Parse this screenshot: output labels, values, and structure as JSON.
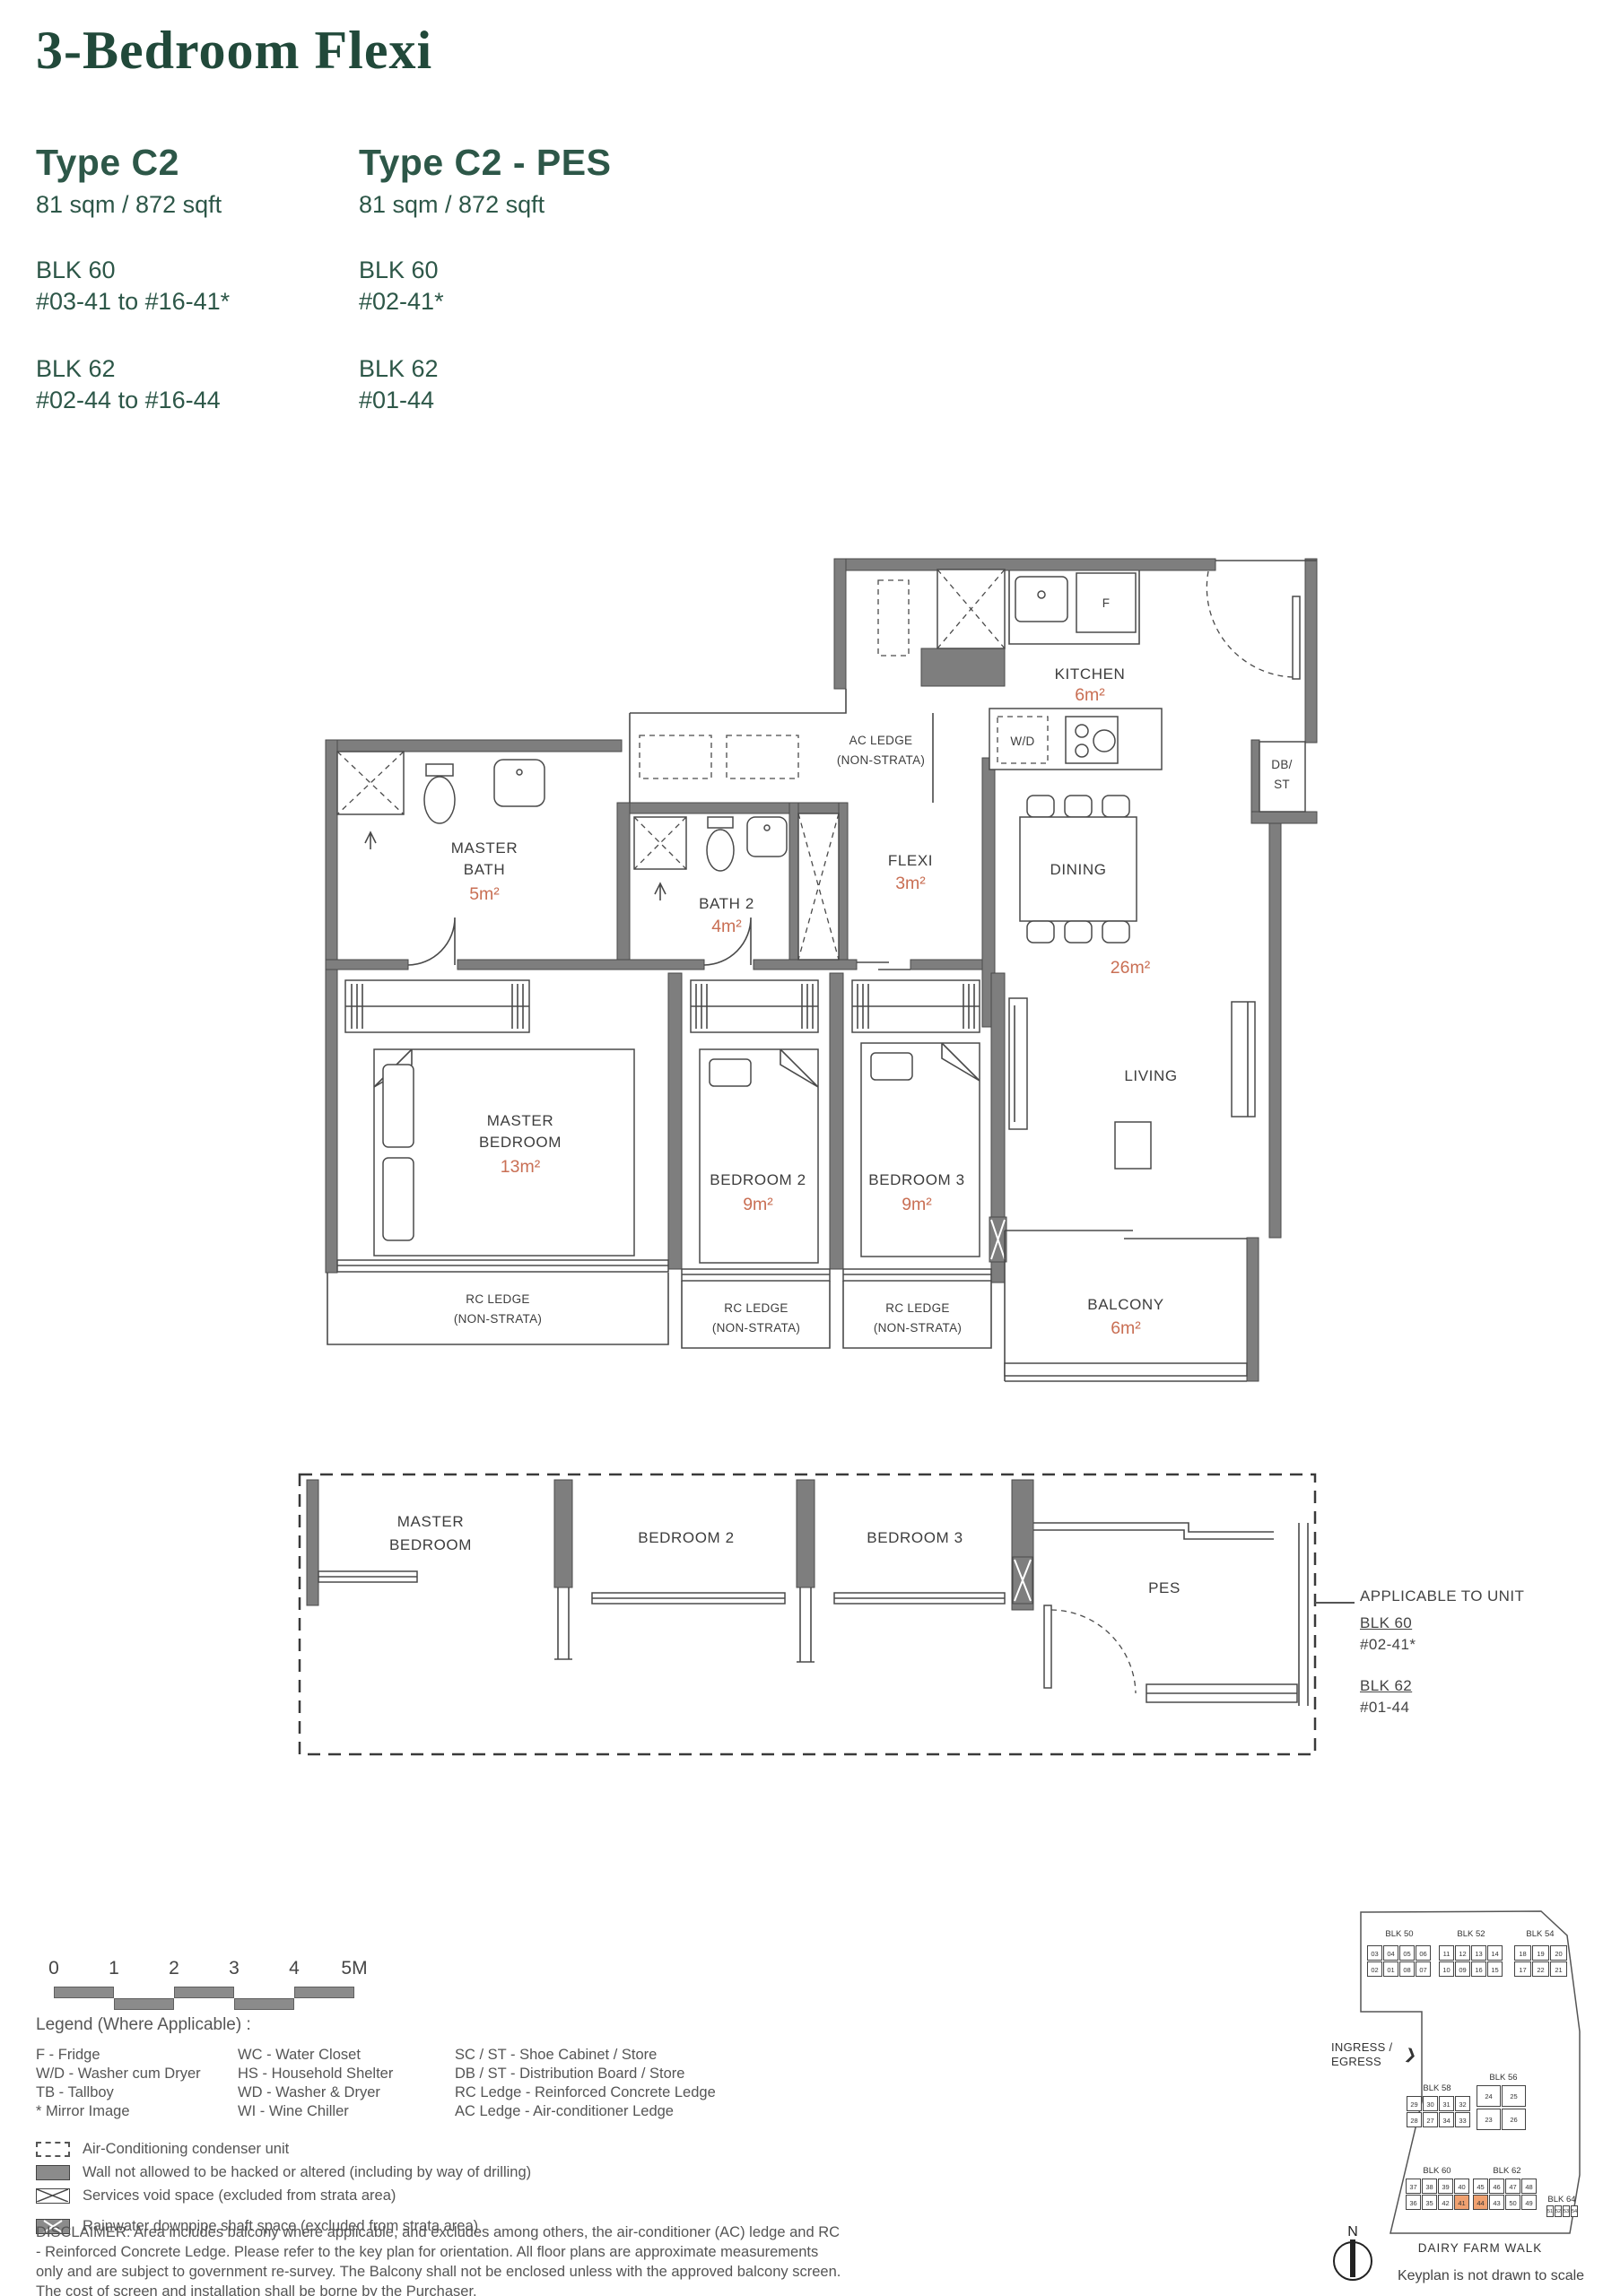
{
  "header": {
    "title": "3-Bedroom Flexi",
    "types": [
      {
        "name": "Type C2",
        "area": "81 sqm / 872 sqft",
        "blocks": [
          {
            "blk": "BLK 60",
            "units": "#03-41 to #16-41*"
          },
          {
            "blk": "BLK 62",
            "units": "#02-44 to #16-44"
          }
        ]
      },
      {
        "name": "Type C2 - PES",
        "area": "81 sqm / 872 sqft",
        "blocks": [
          {
            "blk": "BLK 60",
            "units": "#02-41*"
          },
          {
            "blk": "BLK 62",
            "units": "#01-44"
          }
        ]
      }
    ]
  },
  "floorplan": {
    "kitchen": {
      "label": "KITCHEN",
      "area": "6m²"
    },
    "fridge": "F",
    "washer_dryer": "W/D",
    "db_st": {
      "l1": "DB/",
      "l2": "ST"
    },
    "ac_ledge": {
      "l1": "AC LEDGE",
      "l2": "(NON-STRATA)"
    },
    "master_bath": {
      "l1": "MASTER",
      "l2": "BATH",
      "area": "5m²"
    },
    "bath2": {
      "label": "BATH 2",
      "area": "4m²"
    },
    "flexi": {
      "label": "FLEXI",
      "area": "3m²"
    },
    "dining": {
      "label": "DINING"
    },
    "living": {
      "label": "LIVING"
    },
    "living_dining_area": "26m²",
    "master_bedroom": {
      "l1": "MASTER",
      "l2": "BEDROOM",
      "area": "13m²"
    },
    "bedroom2": {
      "label": "BEDROOM 2",
      "area": "9m²"
    },
    "bedroom3": {
      "label": "BEDROOM 3",
      "area": "9m²"
    },
    "balcony": {
      "label": "BALCONY",
      "area": "6m²"
    },
    "rc_ledge": {
      "l1": "RC LEDGE",
      "l2": "(NON-STRATA)"
    }
  },
  "pes_plan": {
    "master_bedroom": {
      "l1": "MASTER",
      "l2": "BEDROOM"
    },
    "bedroom2": "BEDROOM 2",
    "bedroom3": "BEDROOM 3",
    "pes": "PES",
    "note": {
      "title": "APPLICABLE TO UNIT",
      "blk1": "BLK 60",
      "unit1": "#02-41*",
      "blk2": "BLK 62",
      "unit2": "#01-44"
    }
  },
  "scalebar": {
    "ticks": [
      "0",
      "1",
      "2",
      "3",
      "4",
      "5M"
    ]
  },
  "legend": {
    "heading": "Legend (Where Applicable) :",
    "col1": [
      "F - Fridge",
      "W/D - Washer cum Dryer",
      "TB - Tallboy",
      "* Mirror Image"
    ],
    "col2": [
      "WC - Water Closet",
      "HS - Household Shelter",
      "WD - Washer & Dryer",
      "WI  - Wine Chiller"
    ],
    "col3": [
      "SC / ST - Shoe Cabinet / Store",
      "DB / ST - Distribution Board / Store",
      "RC Ledge - Reinforced Concrete Ledge",
      "AC Ledge - Air-conditioner Ledge"
    ],
    "symbols": [
      {
        "icon": "ac-condenser-dashed-box",
        "label": "Air-Conditioning condenser unit"
      },
      {
        "icon": "no-hack-wall-box",
        "label": "Wall not allowed to be hacked or altered (including by way of drilling)"
      },
      {
        "icon": "services-void-box",
        "label": "Services void space (excluded from strata area)"
      },
      {
        "icon": "rainwater-downpipe-box",
        "label": "Rainwater downpipe shaft space (excluded from strata area)"
      }
    ]
  },
  "disclaimer": "DISCLAIMER: Area includes balcony where applicable, and excludes among others, the air-conditioner (AC) ledge and RC - Reinforced Concrete Ledge. Please refer to the key plan for orientation. All floor plans are approximate measurements only and are subject to government re-survey. The Balcony shall not be enclosed unless with the approved balcony screen. The cost of screen and installation shall be borne by the Purchaser.",
  "keyplan": {
    "ingress_l1": "INGRESS /",
    "ingress_l2": "EGRESS",
    "street": "DAIRY FARM WALK",
    "note": "Keyplan is not drawn to scale",
    "north": "N",
    "highlight_color": "#f0a170",
    "highlight_units": [
      "41",
      "44"
    ],
    "blocks": [
      {
        "name": "BLK 50",
        "rows": [
          [
            "03",
            "04",
            "05",
            "06"
          ],
          [
            "02",
            "01",
            "08",
            "07"
          ]
        ]
      },
      {
        "name": "BLK 52",
        "rows": [
          [
            "11",
            "12",
            "13",
            "14"
          ],
          [
            "10",
            "09",
            "16",
            "15"
          ]
        ]
      },
      {
        "name": "BLK 54",
        "rows": [
          [
            "18",
            "19",
            "20"
          ],
          [
            "17",
            "22",
            "21"
          ]
        ]
      },
      {
        "name": "BLK 56",
        "rows": [
          [
            "24",
            "25"
          ],
          [
            "23",
            "26"
          ]
        ]
      },
      {
        "name": "BLK 58",
        "rows": [
          [
            "29",
            "30",
            "31",
            "32"
          ],
          [
            "28",
            "27",
            "34",
            "33"
          ]
        ]
      },
      {
        "name": "BLK 60",
        "rows": [
          [
            "37",
            "38",
            "39",
            "40"
          ],
          [
            "36",
            "35",
            "42",
            "41"
          ]
        ]
      },
      {
        "name": "BLK 62",
        "rows": [
          [
            "45",
            "46",
            "47",
            "48"
          ],
          [
            "44",
            "43",
            "50",
            "49"
          ]
        ]
      },
      {
        "name": "BLK 64",
        "rows": [
          [
            "51",
            "52",
            "53",
            "54"
          ]
        ]
      }
    ]
  },
  "colors": {
    "title_green": "#21493a",
    "accent_green": "#2d5748",
    "area_orange": "#c96f54",
    "wall_gray": "#7e7e7e",
    "keyplan_highlight": "#f0a170"
  }
}
